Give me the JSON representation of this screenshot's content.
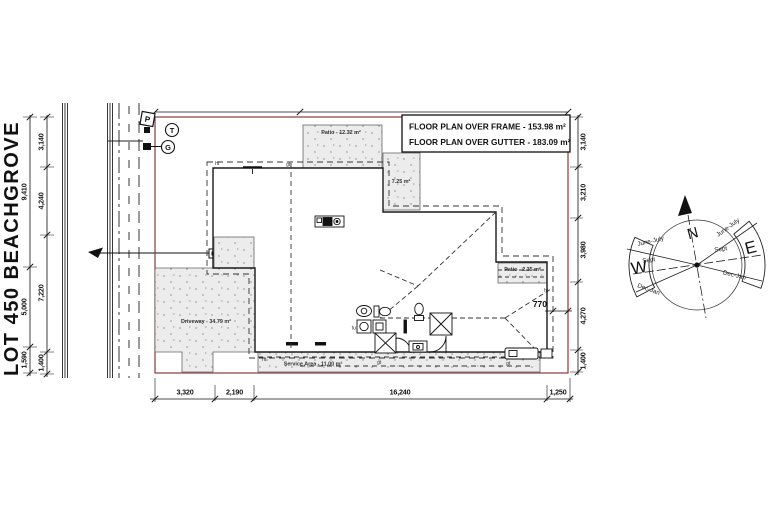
{
  "lot": {
    "label": "LOT 450 BEACHGROVE"
  },
  "title_block": {
    "frame_area": "FLOOR PLAN OVER FRAME - 153.98 m²",
    "gutter_area": "FLOOR PLAN OVER GUTTER - 183.09 m²"
  },
  "areas": {
    "patio_top": "Patio - 12.32 m²",
    "patio_side": "7.25 m²",
    "patio_right": "Patio - 2.35 m²",
    "driveway": "Driveway - 34.79 m²",
    "service": "Service Area - 11.00 m²"
  },
  "dimensions": {
    "left_outer": [
      "9,410",
      "5,000",
      "1,590"
    ],
    "left_inner": [
      "3,140",
      "4,240",
      "7,220",
      "1,400"
    ],
    "right": [
      "3,140",
      "3,210",
      "3,980",
      "4,270",
      "1,400"
    ],
    "bottom": [
      "3,320",
      "2,190",
      "16,240",
      "1,250"
    ],
    "eave_offset": "770"
  },
  "utilities": {
    "power": "P",
    "telephone": "T",
    "gas": "G"
  },
  "plan_markers": {
    "ht": "ht",
    "gt": "gt",
    "tub": "tu"
  },
  "compass": {
    "north": "N",
    "east": "E",
    "west": "W",
    "seasons": [
      "June-July",
      "Sept",
      "Dec-Jan"
    ]
  },
  "colors": {
    "boundary": "#8B3A3A",
    "ink": "#1a1a1a",
    "stipple_bg": "#ececec"
  }
}
